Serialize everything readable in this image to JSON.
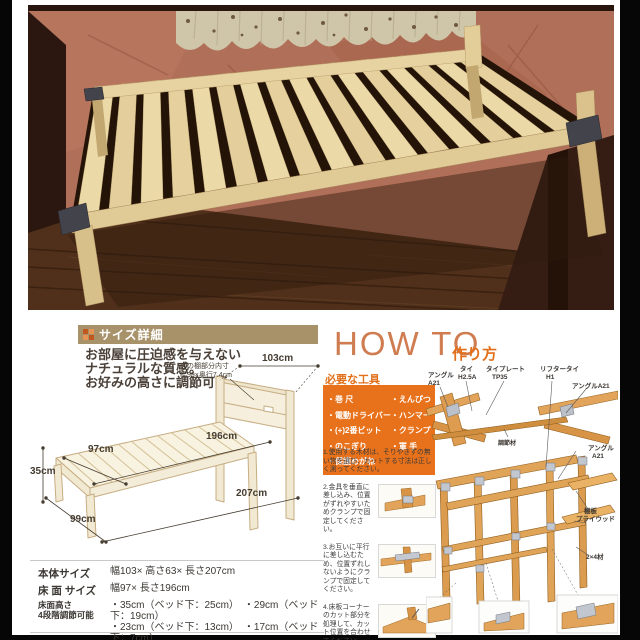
{
  "colors": {
    "accent_orange": "#e8721b",
    "banner_tan": "#a8926a",
    "howto_title_color": "#cf7c50"
  },
  "size_section": {
    "header": "サイズ詳細",
    "intro1": "お部屋に圧迫感を与えない",
    "intro2": "ナチュラルな質感。",
    "intro3": "お好みの高さに調節可能",
    "dims": {
      "shelf_note1": "宮の棚部分内寸",
      "shelf_note2": "幅99×奥行7.4cm",
      "top_width": "103cm",
      "inner_length": "196cm",
      "inner_width": "97cm",
      "height": "35cm",
      "bottom_width": "99cm",
      "total_length": "207cm"
    },
    "specs": {
      "body_label": "本体サイズ",
      "body_value": "幅103× 高さ63× 長さ207cm",
      "surface_label": "床 面 サイズ",
      "surface_value": "幅97× 長さ196cm",
      "height_label1": "床面高さ",
      "height_label2": "4段階調節可能",
      "height_value1": "・35cm（ベッド下：25cm）　・29cm（ベッド下：19cm）",
      "height_value2": "・23cm（ベッド下：13cm）　・17cm（ベッド下：7cm）",
      "spec_label": "仕　様",
      "spec_value1": "2口コンセント付き",
      "spec_value2": "国産（日本製）"
    }
  },
  "howto": {
    "title": "HOW TO",
    "subtitle": "作り方",
    "tools_header": "必要な工具",
    "tools_col1": [
      "・巻 尺",
      "・電動ドライバー",
      "・(+)2番ビット",
      "・のこぎり",
      "・保護めがね"
    ],
    "tools_col2": [
      "・えんぴつ",
      "・ハンマー",
      "・クランプ",
      "・軍 手"
    ],
    "steps": {
      "s1": "1.使用する木材は、そりやきずの無い物を選び、カットする寸法は正しく測ってください。",
      "s2": "2.金具を垂直に差し込み、位置がずれやすいためクランプで固定してください。",
      "s3": "3.お互いに平行に差し込むため、位置ずれしないようにクランプで固定してください。",
      "s4": "4.床板コーナーのカット部分を処理して、カット位置を合わせてください。"
    },
    "parts": {
      "angle1a": "アングル",
      "angle1b": "A21",
      "tie1a": "タイ",
      "tie1b": "H2.5A",
      "plate1a": "タイプレート",
      "plate1b": "TP35",
      "lifter1a": "リフタータイ",
      "lifter1b": "H1",
      "angle2": "アングルA21",
      "board": "調節材",
      "angle3a": "アングル",
      "angle3b": "A21",
      "shelf1": "棚板",
      "shelf2": "プライウッド",
      "lumber": "2×4材"
    }
  }
}
